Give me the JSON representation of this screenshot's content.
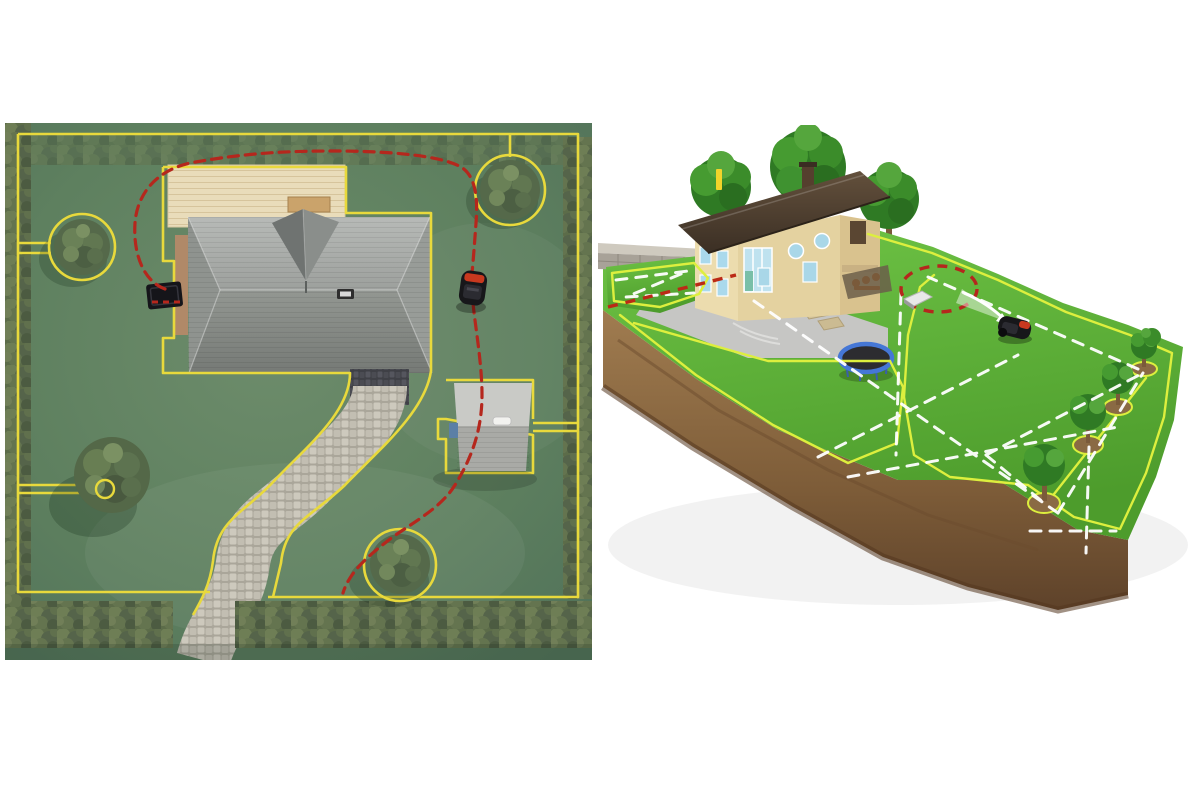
{
  "page": {
    "background": "#ffffff",
    "description": "Two illustrations of a robotic lawn mower installation: a top-down yard map with boundary wire and guide wire (left) and an isometric 3D lawn diorama with mowing pattern (right)"
  },
  "colors": {
    "boundary_wire": "#e8d93c",
    "boundary_wire_right": "#ddef3e",
    "guide_wire": "#b5271d",
    "lawn_left": "#5e7f5e",
    "lawn_right": "#5cb335",
    "hedge_green": "#5c6c49",
    "soil_brown": "#8a6a44",
    "roof_left_gray": "#9a9d9a",
    "roof_right_brown": "#4e3e2f",
    "house_wall_beige": "#e4d2a0",
    "window_blue": "#a9d7e8",
    "deck_wood": "#e9dcba",
    "path_stone": "#c8c4b8",
    "patio_gray": "#c6c6c4",
    "stone_wall_gray": "#a8a298",
    "mower_body": "#17171a",
    "mower_accent": "#c8391f",
    "trampoline_rim": "#4577d6",
    "trampoline_mat": "#2c2c30",
    "mow_path_white": "#ffffff",
    "marker_yellow": "#f2d42a",
    "charging_station_dark": "#15151a",
    "charging_station_light": "#e8e8e8"
  },
  "left_panel": {
    "name": "top-down yard boundary-wire map",
    "view": "top-down",
    "objects": [
      "perimeter-boundary-wire",
      "guide-wire",
      "charging-station",
      "robotic-mower",
      "house-hip-roof",
      "wooden-deck",
      "deck-bench",
      "roof-vent",
      "cobblestone-path",
      "garden-shed",
      "shed-vent",
      "shed-door",
      "hedge-left",
      "hedge-bottom",
      "tree-line-top",
      "hedge-right",
      "bush-island-top-left",
      "bush-island-top-right",
      "tree-island-bottom-left",
      "bush-island-bottom-middle"
    ]
  },
  "right_panel": {
    "name": "isometric lawn diorama with mowing pattern",
    "view": "isometric-3d",
    "objects": [
      "lawn-terrain",
      "soil-cutaway",
      "two-story-house",
      "chimney",
      "round-windows",
      "tall-window",
      "background-trees",
      "stone-retaining-wall",
      "driveway-patio",
      "patio-steps",
      "covered-terrace",
      "trampoline",
      "robotic-mower",
      "charging-station",
      "boundary-wire-loops",
      "guide-wire-loop",
      "mowing-path-dashes",
      "tree-wire-islands",
      "direction-arrow",
      "yellow-marker-bar",
      "small-bush"
    ]
  }
}
